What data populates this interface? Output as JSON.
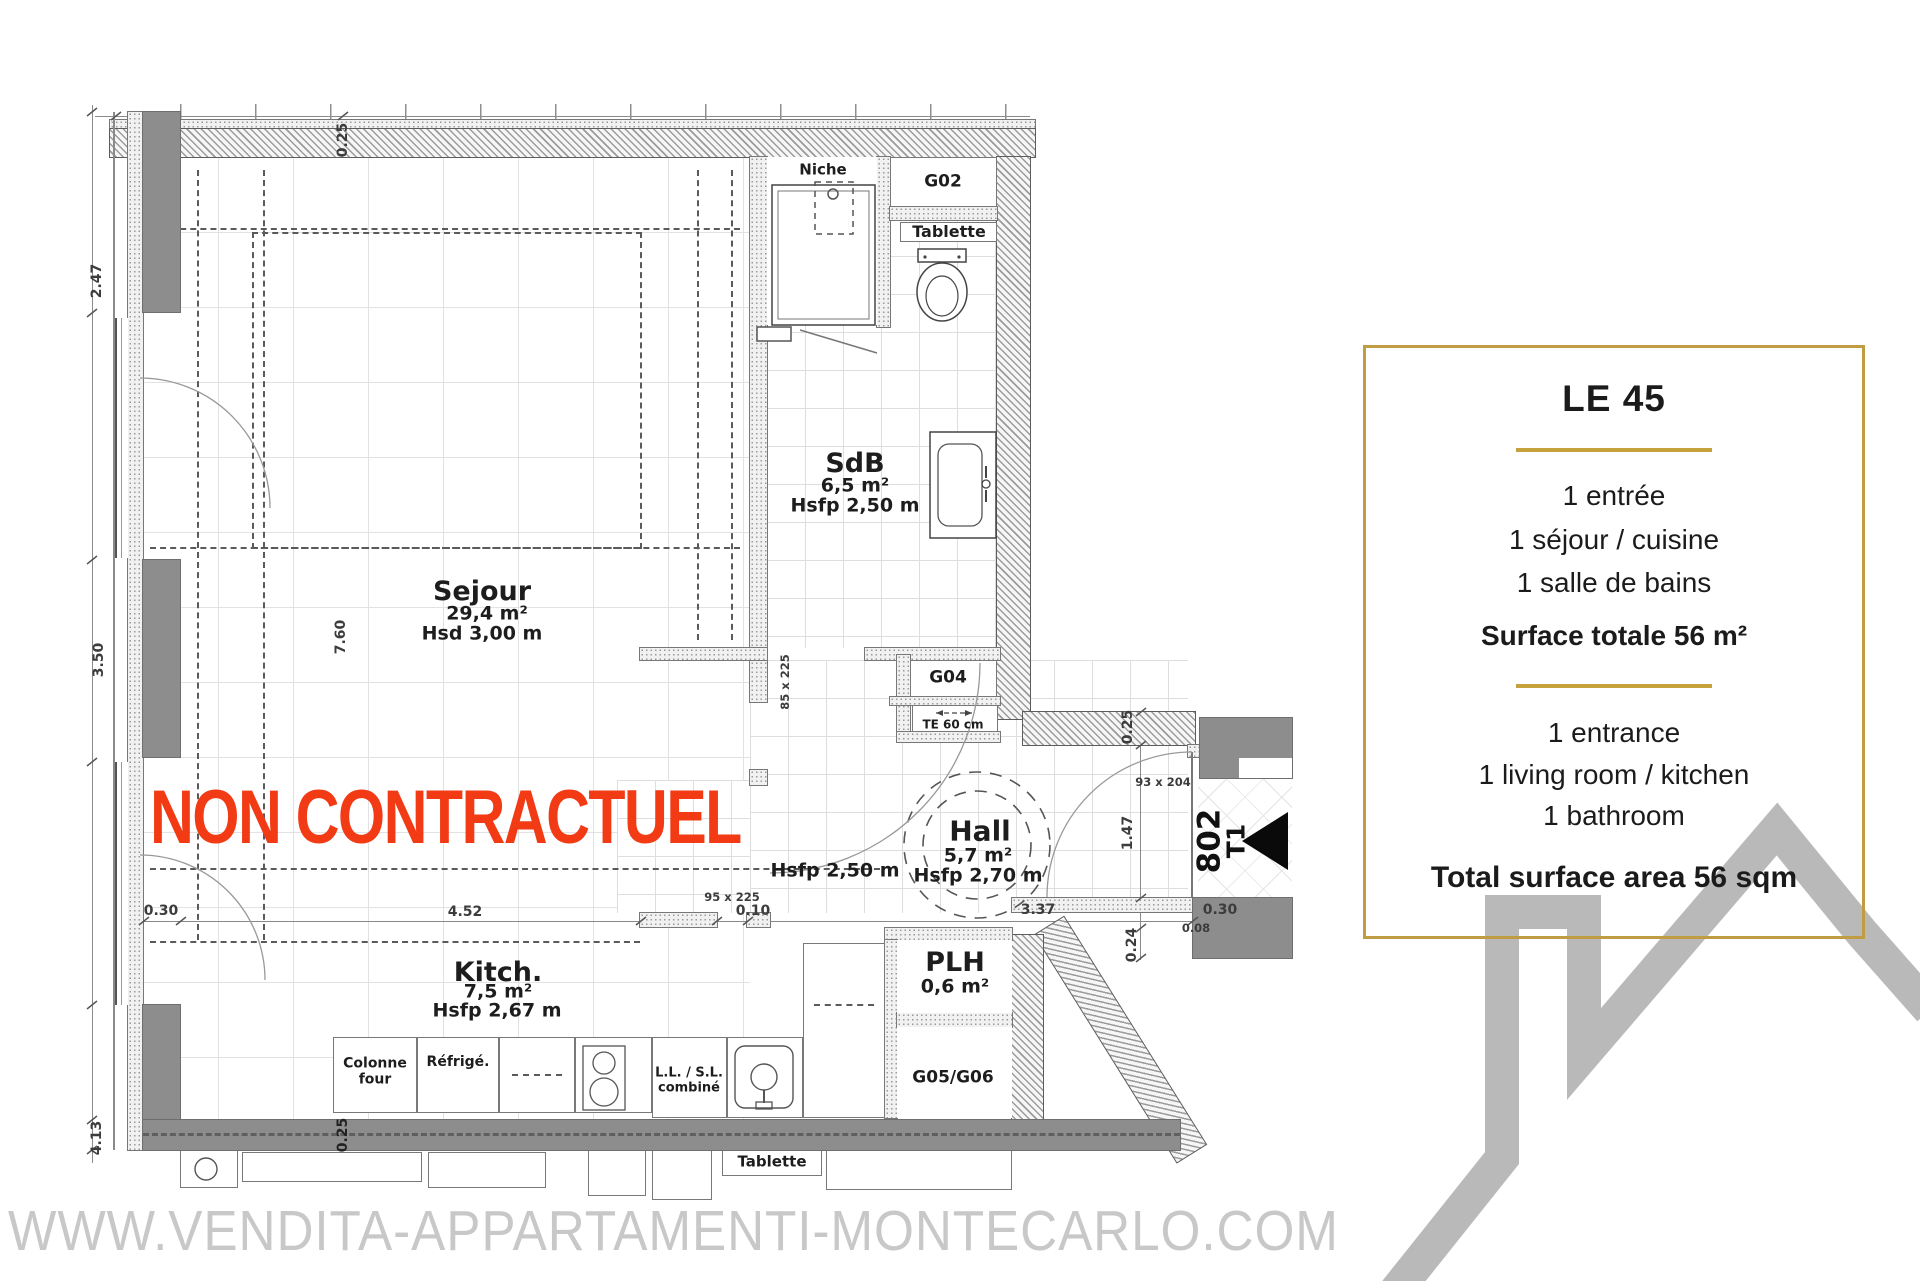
{
  "panel": {
    "title": "LE 45",
    "fr": {
      "items": [
        "1 entrée",
        "1 séjour / cuisine",
        "1 salle de bains"
      ],
      "total": "Surface totale 56 m²"
    },
    "en": {
      "items": [
        "1 entrance",
        "1 living room / kitchen",
        "1 bathroom"
      ],
      "total": "Total surface area 56 sqm"
    }
  },
  "watermark": "WWW.VENDITA-APPARTAMENTI-MONTECARLO.COM",
  "disclaimer": "NON CONTRACTUEL",
  "rooms": {
    "sejour": {
      "name": "Sejour",
      "area": "29,4 m²",
      "height": "Hsd 3,00 m"
    },
    "kitchen": {
      "name": "Kitch.",
      "area": "7,5 m²",
      "height": "Hsfp 2,67 m"
    },
    "sdb": {
      "name": "SdB",
      "area": "6,5 m²",
      "height": "Hsfp 2,50 m"
    },
    "hall": {
      "name": "Hall",
      "area": "5,7 m²",
      "height": "Hsfp 2,70 m"
    },
    "entry": {
      "height": "Hsfp 2,50 m"
    },
    "plh": {
      "name": "PLH",
      "area": "0,6 m²"
    }
  },
  "closets": {
    "niche": "Niche",
    "g02": "G02",
    "tablette_top": "Tablette",
    "g04": "G04",
    "te": "TE 60 cm",
    "g05": "G05/G06",
    "tablette_bottom": "Tablette"
  },
  "appliances": {
    "oven": "Colonne\nfour",
    "fridge": "Réfrigé.",
    "washer": "L.L. / S.L.\ncombiné"
  },
  "unit": {
    "number": "802",
    "type": "T1"
  },
  "dims": {
    "top": "0.25",
    "left1": "2.47",
    "left2": "3.50",
    "left3": "4.13",
    "left_door": "0.30",
    "sejour_len": "7.60",
    "kitchen_len": "4.52",
    "d010": "0.10",
    "door95": "95 x 225",
    "door85": "85 x 225",
    "hall_w": "3.37",
    "hall_h": "1.47",
    "right_top": "0.25",
    "d024": "0.24",
    "d030": "0.30",
    "d008": "0.08",
    "door93": "93 x 204",
    "band": "0.25"
  },
  "colors": {
    "accent_gold": "#c09d42",
    "alert_red": "#f23b15",
    "logo_gray": "#b9b9b9",
    "wall_gray": "#8d8d8d"
  }
}
